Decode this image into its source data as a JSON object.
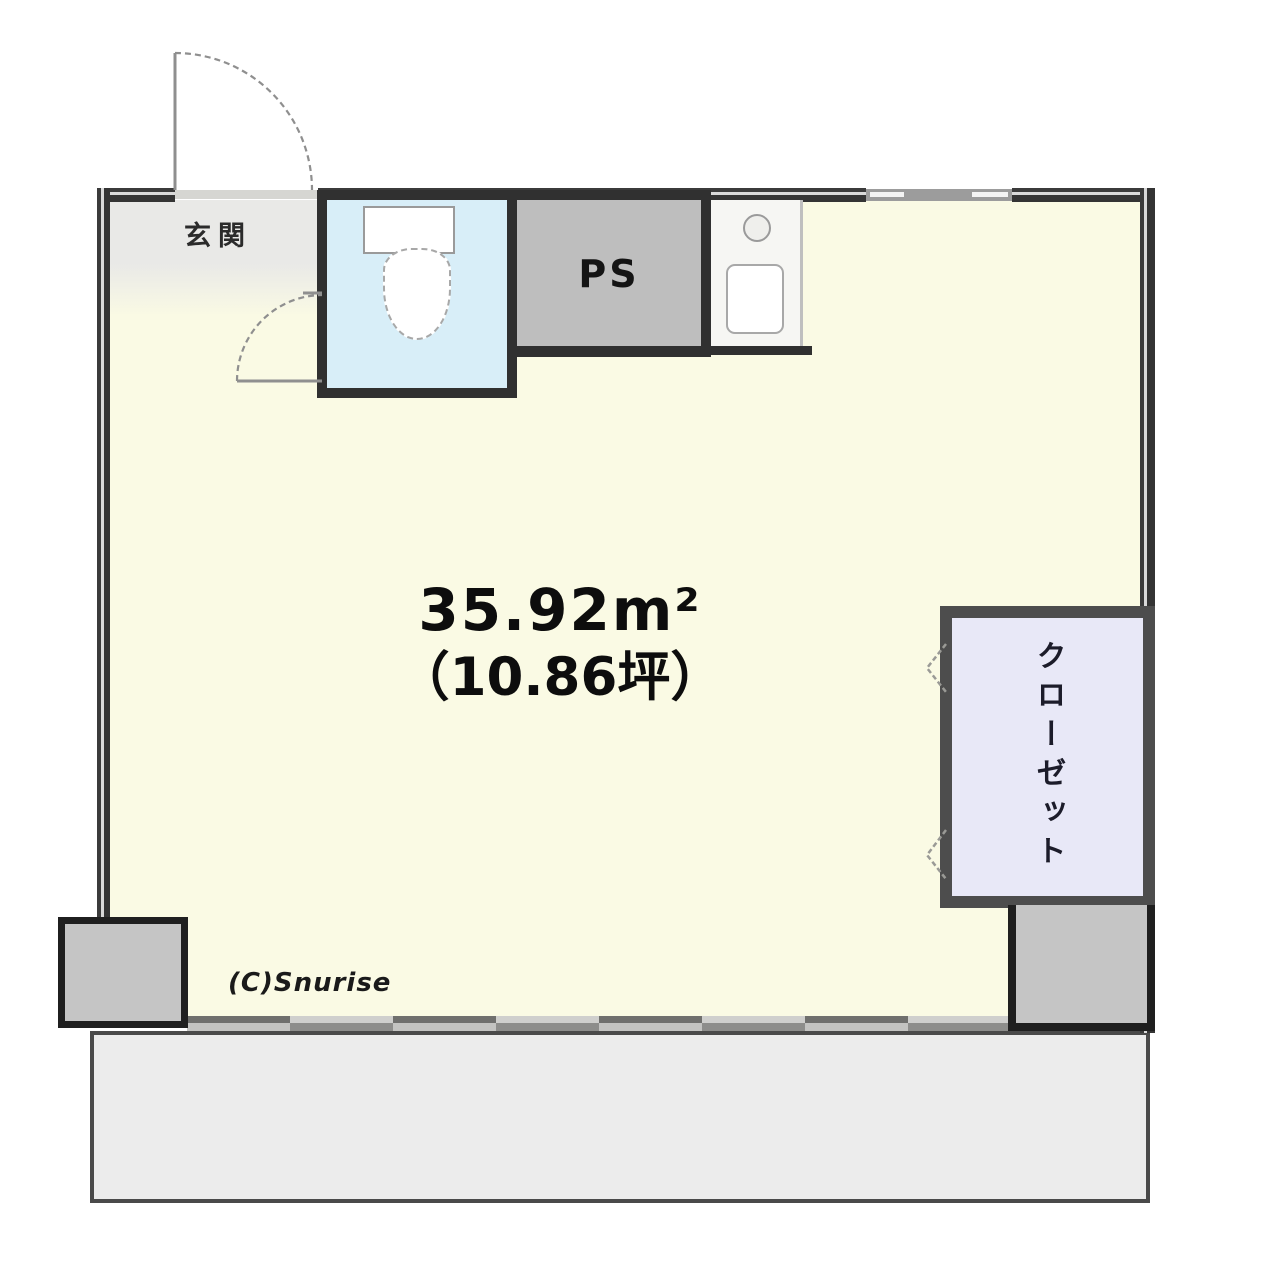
{
  "floorplan": {
    "area": {
      "value": "35.92",
      "unit": "m²",
      "tsubo": "（10.86坪）"
    },
    "labels": {
      "entrance": "玄関",
      "pipe_space": "PS",
      "closet": "クローゼット"
    },
    "copyright": "(C)Snurise",
    "icons": [
      "toilet-icon",
      "faucet-icon",
      "sink-icon",
      "door-swing-arc-icon",
      "folding-door-chevron-icon",
      "window-icon",
      "sliding-door-icon"
    ],
    "colors": {
      "main_room": "#FAFAE4",
      "toilet_room": "#D8EEF8",
      "pipe_space": "#BEBEBE",
      "closet": "#E8E8F7",
      "entrance": "#E9E9E7",
      "balcony": "#ECECEC",
      "pillar": "#C5C5C5",
      "wall": "#303030"
    }
  }
}
